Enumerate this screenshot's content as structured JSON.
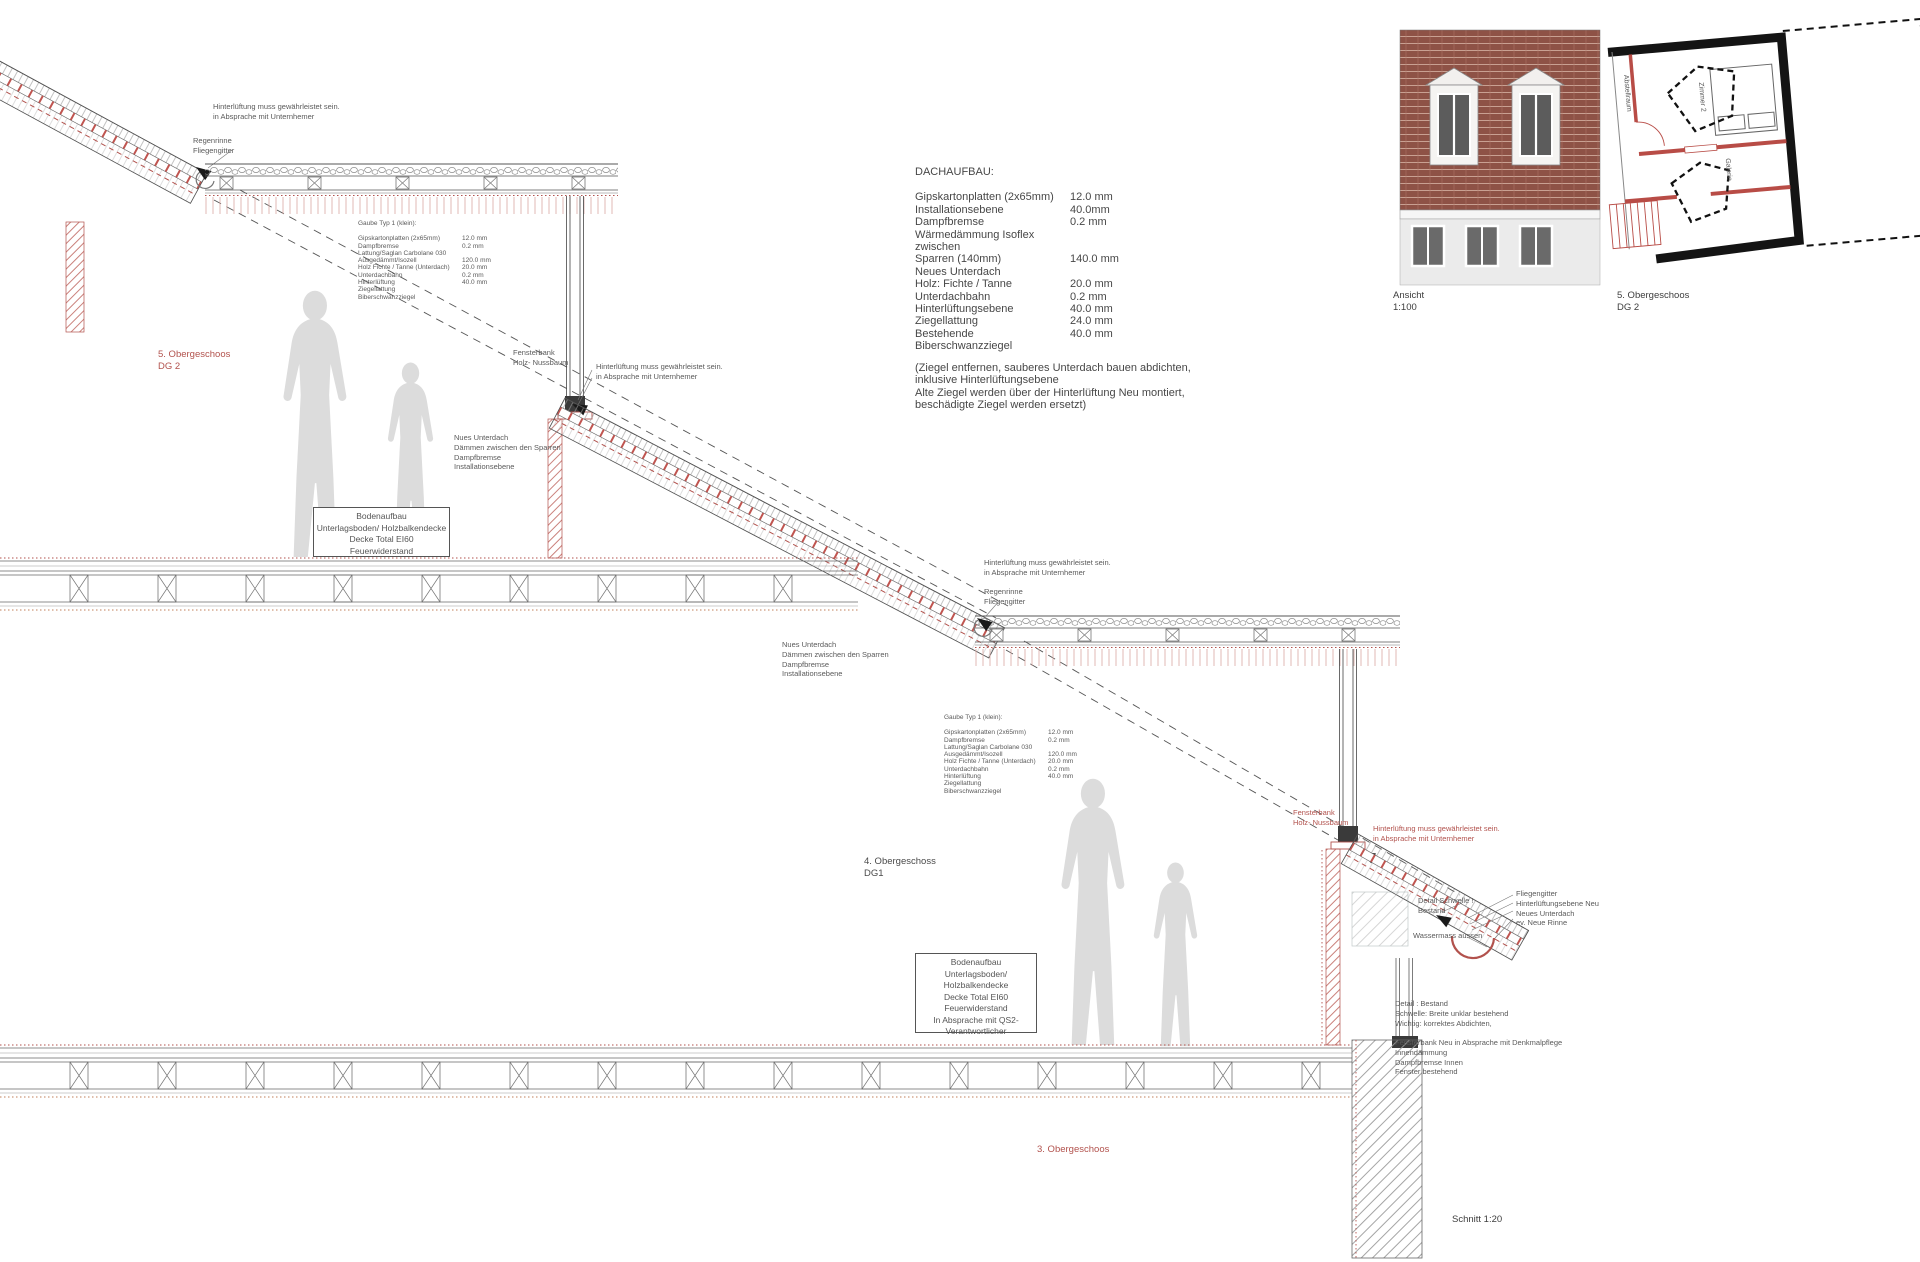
{
  "colors": {
    "accent_red": "#b2524d",
    "line_gray": "#555555",
    "silhouette_gray": "#dcdcdc",
    "brick_brown": "#8e5246"
  },
  "dachaufbau": {
    "title": "DACHAUFBAU:",
    "rows": [
      {
        "label": "Gipskartonplatten (2x65mm)",
        "value": "12.0 mm"
      },
      {
        "label": "Installationsebene",
        "value": "40.0mm"
      },
      {
        "label": "Dampfbremse",
        "value": "0.2 mm"
      },
      {
        "label": "Wärmedämmung Isoflex zwischen",
        "value": ""
      },
      {
        "label": "Sparren (140mm)",
        "value": "140.0 mm"
      },
      {
        "label": "Neues Unterdach",
        "value": ""
      },
      {
        "label": "Holz: Fichte / Tanne",
        "value": "20.0 mm"
      },
      {
        "label": "Unterdachbahn",
        "value": "0.2 mm"
      },
      {
        "label": "Hinterlüftungsebene",
        "value": "40.0 mm"
      },
      {
        "label": "Ziegellattung",
        "value": "24.0 mm"
      },
      {
        "label": "Bestehende Biberschwanzziegel",
        "value": "40.0 mm"
      }
    ],
    "note": "(Ziegel entfernen, sauberes Unterdach bauen abdichten,\ninklusive Hinterlüftungsebene\nAlte Ziegel werden über der Hinterlüftung Neu montiert,\nbeschädigte Ziegel werden ersetzt)"
  },
  "gaube": {
    "title": "Gaube Typ 1 (klein):",
    "rows": [
      {
        "label": "Gipskartonplatten (2x65mm)",
        "value": "12.0 mm"
      },
      {
        "label": "Dampfbremse",
        "value": "0.2 mm"
      },
      {
        "label": "Lattung/Saglan Carbolane 030",
        "value": ""
      },
      {
        "label": "Ausgedämmt/Isozell",
        "value": "120.0 mm"
      },
      {
        "label": "Holz Fichte / Tanne (Unterdach)",
        "value": "20.0 mm"
      },
      {
        "label": "Unterdachbahn",
        "value": "0.2 mm"
      },
      {
        "label": "Hinterlüftung",
        "value": "40.0 mm"
      },
      {
        "label": "Ziegellattung",
        "value": ""
      },
      {
        "label": "Biberschwanzziegel",
        "value": ""
      }
    ]
  },
  "bodenaufbau_upper": {
    "lines": [
      "Bodenaufbau",
      "Unterlagsboden/ Holzbalkendecke",
      "Decke Total EI60",
      "Feuerwiderstand"
    ]
  },
  "bodenaufbau_lower": {
    "lines": [
      "Bodenaufbau",
      "Unterlagsboden/ Holzbalkendecke",
      "Decke Total EI60",
      "Feuerwiderstand",
      "In Absprache mit QS2-",
      "Verantwortlicher"
    ]
  },
  "annotations": {
    "ventilation": "Hinterlüftung muss gewährleistet sein.\nin Absprache mit Unternhemer",
    "gutter": "Regenrinne\nFliegengitter",
    "windowsill": "Fensterbank\nHolz- Nussbaum",
    "new_underroof": "Nues Unterdach\nDämmen zwischen den Sparren\nDampfbremse\nInstallationsebene",
    "detail_sill": "Detail Schwelle !\nBestand",
    "eaves_layers": "Fliegengitter\nHinterlüftungsebene Neu\nNeues Unterdach\nev. Neue Rinne",
    "water_dim": "Wassermass aussen",
    "detail_bestand": "Detail : Bestand\nSchwelle: Breite unklar bestehend\nWichtig: korrektes Abdichten,\n\nFensterbank Neu in Absprache mit Denkmalpflege\nInnendämmung\nDampfbremse Innen\nFenster bestehend"
  },
  "levels": {
    "dg2": "5. Obergeschoos\nDG 2",
    "dg1": "4. Obergeschoss\nDG1",
    "og3": "3. Obergeschoos"
  },
  "views": {
    "ansicht": "Ansicht\n1:100",
    "plan": "5. Obergeschoos\nDG 2",
    "schnitt": "Schnitt 1:20"
  },
  "plan_rooms": {
    "room1": "Abstellraum",
    "room2": "Zimmer 2",
    "room3": "Galerie"
  }
}
